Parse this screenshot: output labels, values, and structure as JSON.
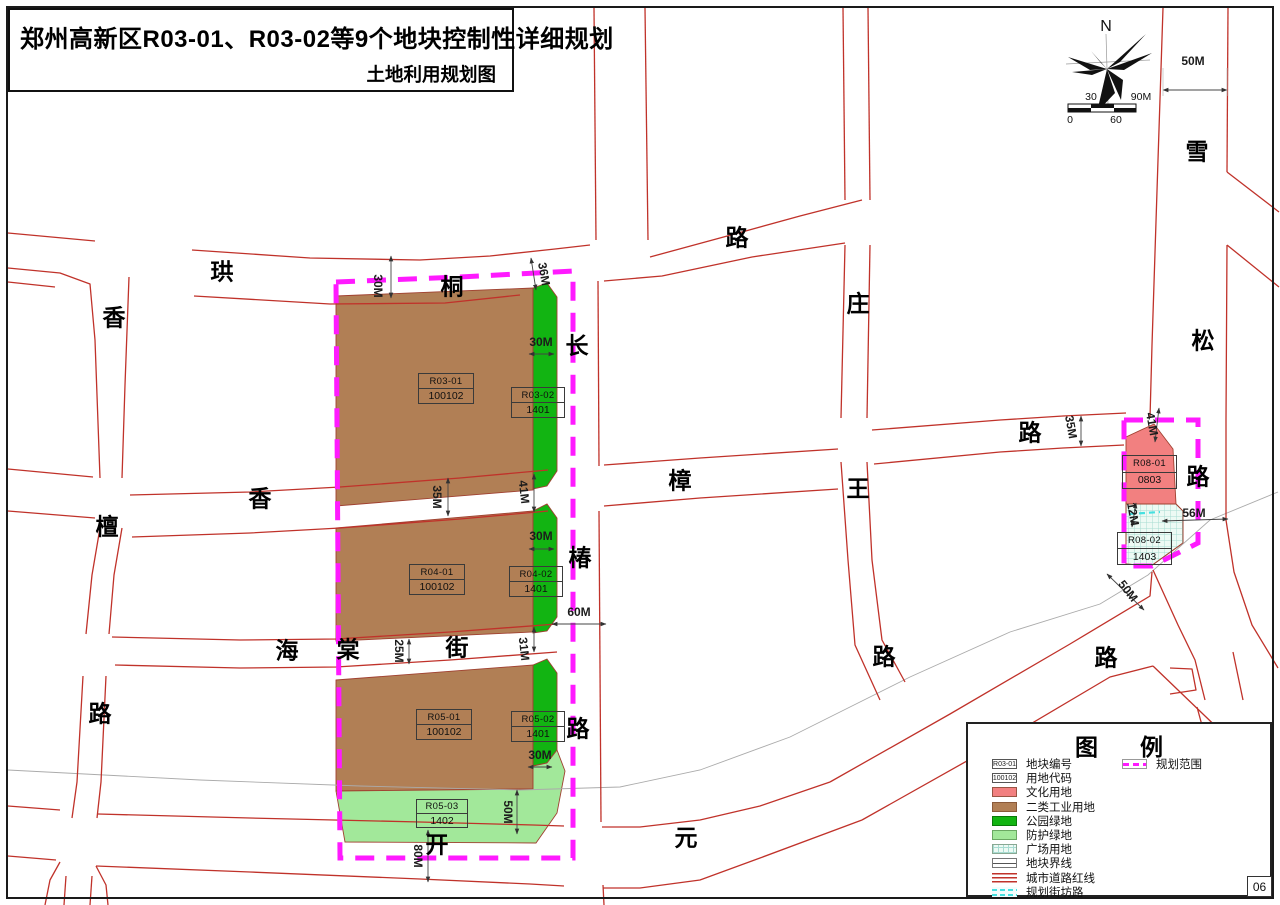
{
  "title": {
    "main": "郑州高新区R03-01、R03-02等9个地块控制性详细规划",
    "sub": "土地利用规划图"
  },
  "page_number": "06",
  "compass": {
    "north_label": "N"
  },
  "scalebar": {
    "above": [
      {
        "t": "30",
        "x": 1091
      },
      {
        "t": "90M",
        "x": 1141
      }
    ],
    "below": [
      {
        "t": "0",
        "x": 1070
      },
      {
        "t": "60",
        "x": 1116
      }
    ],
    "y_above": 97,
    "y_below": 120
  },
  "map": {
    "road_chars": [
      {
        "t": "珙",
        "x": 222,
        "y": 272
      },
      {
        "t": "桐",
        "x": 452,
        "y": 287
      },
      {
        "t": "路",
        "x": 737,
        "y": 238
      },
      {
        "t": "香",
        "x": 114,
        "y": 318
      },
      {
        "t": "檀",
        "x": 107,
        "y": 527
      },
      {
        "t": "路",
        "x": 100,
        "y": 714
      },
      {
        "t": "香",
        "x": 260,
        "y": 499
      },
      {
        "t": "樟",
        "x": 680,
        "y": 481
      },
      {
        "t": "路",
        "x": 1030,
        "y": 433
      },
      {
        "t": "海",
        "x": 287,
        "y": 651
      },
      {
        "t": "棠",
        "x": 348,
        "y": 650
      },
      {
        "t": "街",
        "x": 457,
        "y": 648
      },
      {
        "t": "长",
        "x": 577,
        "y": 346
      },
      {
        "t": "椿",
        "x": 580,
        "y": 558
      },
      {
        "t": "路",
        "x": 578,
        "y": 729
      },
      {
        "t": "庄",
        "x": 858,
        "y": 304
      },
      {
        "t": "王",
        "x": 858,
        "y": 489
      },
      {
        "t": "路",
        "x": 884,
        "y": 657
      },
      {
        "t": "雪",
        "x": 1197,
        "y": 152
      },
      {
        "t": "松",
        "x": 1203,
        "y": 341
      },
      {
        "t": "路",
        "x": 1198,
        "y": 477
      },
      {
        "t": "开",
        "x": 437,
        "y": 845
      },
      {
        "t": "元",
        "x": 686,
        "y": 838
      },
      {
        "t": "路",
        "x": 1106,
        "y": 658
      }
    ],
    "dims": [
      {
        "t": "50M",
        "x": 1193,
        "y": 61,
        "r": 0
      },
      {
        "t": "30M",
        "x": 378,
        "y": 286,
        "r": 90
      },
      {
        "t": "36M",
        "x": 544,
        "y": 274,
        "r": 80
      },
      {
        "t": "30M",
        "x": 541,
        "y": 342,
        "r": 0
      },
      {
        "t": "35M",
        "x": 437,
        "y": 497,
        "r": 90
      },
      {
        "t": "41M",
        "x": 524,
        "y": 492,
        "r": 84
      },
      {
        "t": "30M",
        "x": 541,
        "y": 536,
        "r": 0
      },
      {
        "t": "60M",
        "x": 579,
        "y": 612,
        "r": 0
      },
      {
        "t": "25M",
        "x": 399,
        "y": 651,
        "r": 90
      },
      {
        "t": "31M",
        "x": 524,
        "y": 649,
        "r": 84
      },
      {
        "t": "30M",
        "x": 540,
        "y": 755,
        "r": 0
      },
      {
        "t": "50M",
        "x": 508,
        "y": 812,
        "r": 90
      },
      {
        "t": "80M",
        "x": 418,
        "y": 856,
        "r": 90
      },
      {
        "t": "35M",
        "x": 1071,
        "y": 427,
        "r": 80
      },
      {
        "t": "41M",
        "x": 1152,
        "y": 424,
        "r": 80
      },
      {
        "t": "12M",
        "x": 1133,
        "y": 514,
        "r": 80
      },
      {
        "t": "56M",
        "x": 1194,
        "y": 513,
        "r": 0
      },
      {
        "t": "50M",
        "x": 1128,
        "y": 591,
        "r": 52
      }
    ],
    "parcels": [
      {
        "id": "R03-01",
        "code": "100102",
        "x": 418,
        "y": 373,
        "w": 56,
        "h": 31
      },
      {
        "id": "R03-02",
        "code": "1401",
        "x": 511,
        "y": 387,
        "w": 54,
        "h": 31
      },
      {
        "id": "R04-01",
        "code": "100102",
        "x": 409,
        "y": 564,
        "w": 56,
        "h": 31
      },
      {
        "id": "R04-02",
        "code": "1401",
        "x": 509,
        "y": 566,
        "w": 54,
        "h": 31
      },
      {
        "id": "R05-01",
        "code": "100102",
        "x": 416,
        "y": 709,
        "w": 56,
        "h": 31
      },
      {
        "id": "R05-02",
        "code": "1401",
        "x": 511,
        "y": 711,
        "w": 54,
        "h": 31
      },
      {
        "id": "R05-03",
        "code": "1402",
        "x": 416,
        "y": 799,
        "w": 52,
        "h": 29
      },
      {
        "id": "R08-01",
        "code": "0803",
        "x": 1122,
        "y": 455,
        "w": 55,
        "h": 34
      },
      {
        "id": "R08-02",
        "code": "1403",
        "x": 1117,
        "y": 532,
        "w": 55,
        "h": 33
      }
    ]
  },
  "legend": {
    "title": "图例",
    "items": [
      {
        "swatch": "parcel-id",
        "swatch_text": "R03-01",
        "label": "地块编号"
      },
      {
        "swatch": "land-code",
        "swatch_text": "100102",
        "label": "用地代码"
      },
      {
        "swatch": "culture",
        "label": "文化用地"
      },
      {
        "swatch": "industry2",
        "label": "二类工业用地"
      },
      {
        "swatch": "park-green",
        "label": "公园绿地"
      },
      {
        "swatch": "buffer-green",
        "label": "防护绿地"
      },
      {
        "swatch": "plaza",
        "label": "广场用地"
      },
      {
        "swatch": "parcel-line",
        "label": "地块界线"
      },
      {
        "swatch": "road-redline",
        "label": "城市道路红线"
      },
      {
        "swatch": "planned-lane",
        "label": "规划街坊路"
      }
    ],
    "items_col2": [
      {
        "swatch": "planning-scope",
        "label": "规划范围"
      }
    ]
  },
  "colors": {
    "road_red": "#C0322A",
    "planning_magenta": "#FF1AFF",
    "culture_pink": "#F28080",
    "industry_brown": "#B17F55",
    "park_green": "#12B412",
    "buffer_green": "#A2E89A",
    "plaza_bg": "#EDFAF4",
    "plaza_grid": "#A8DCD2",
    "lane_cyan": "#45E0E0"
  }
}
